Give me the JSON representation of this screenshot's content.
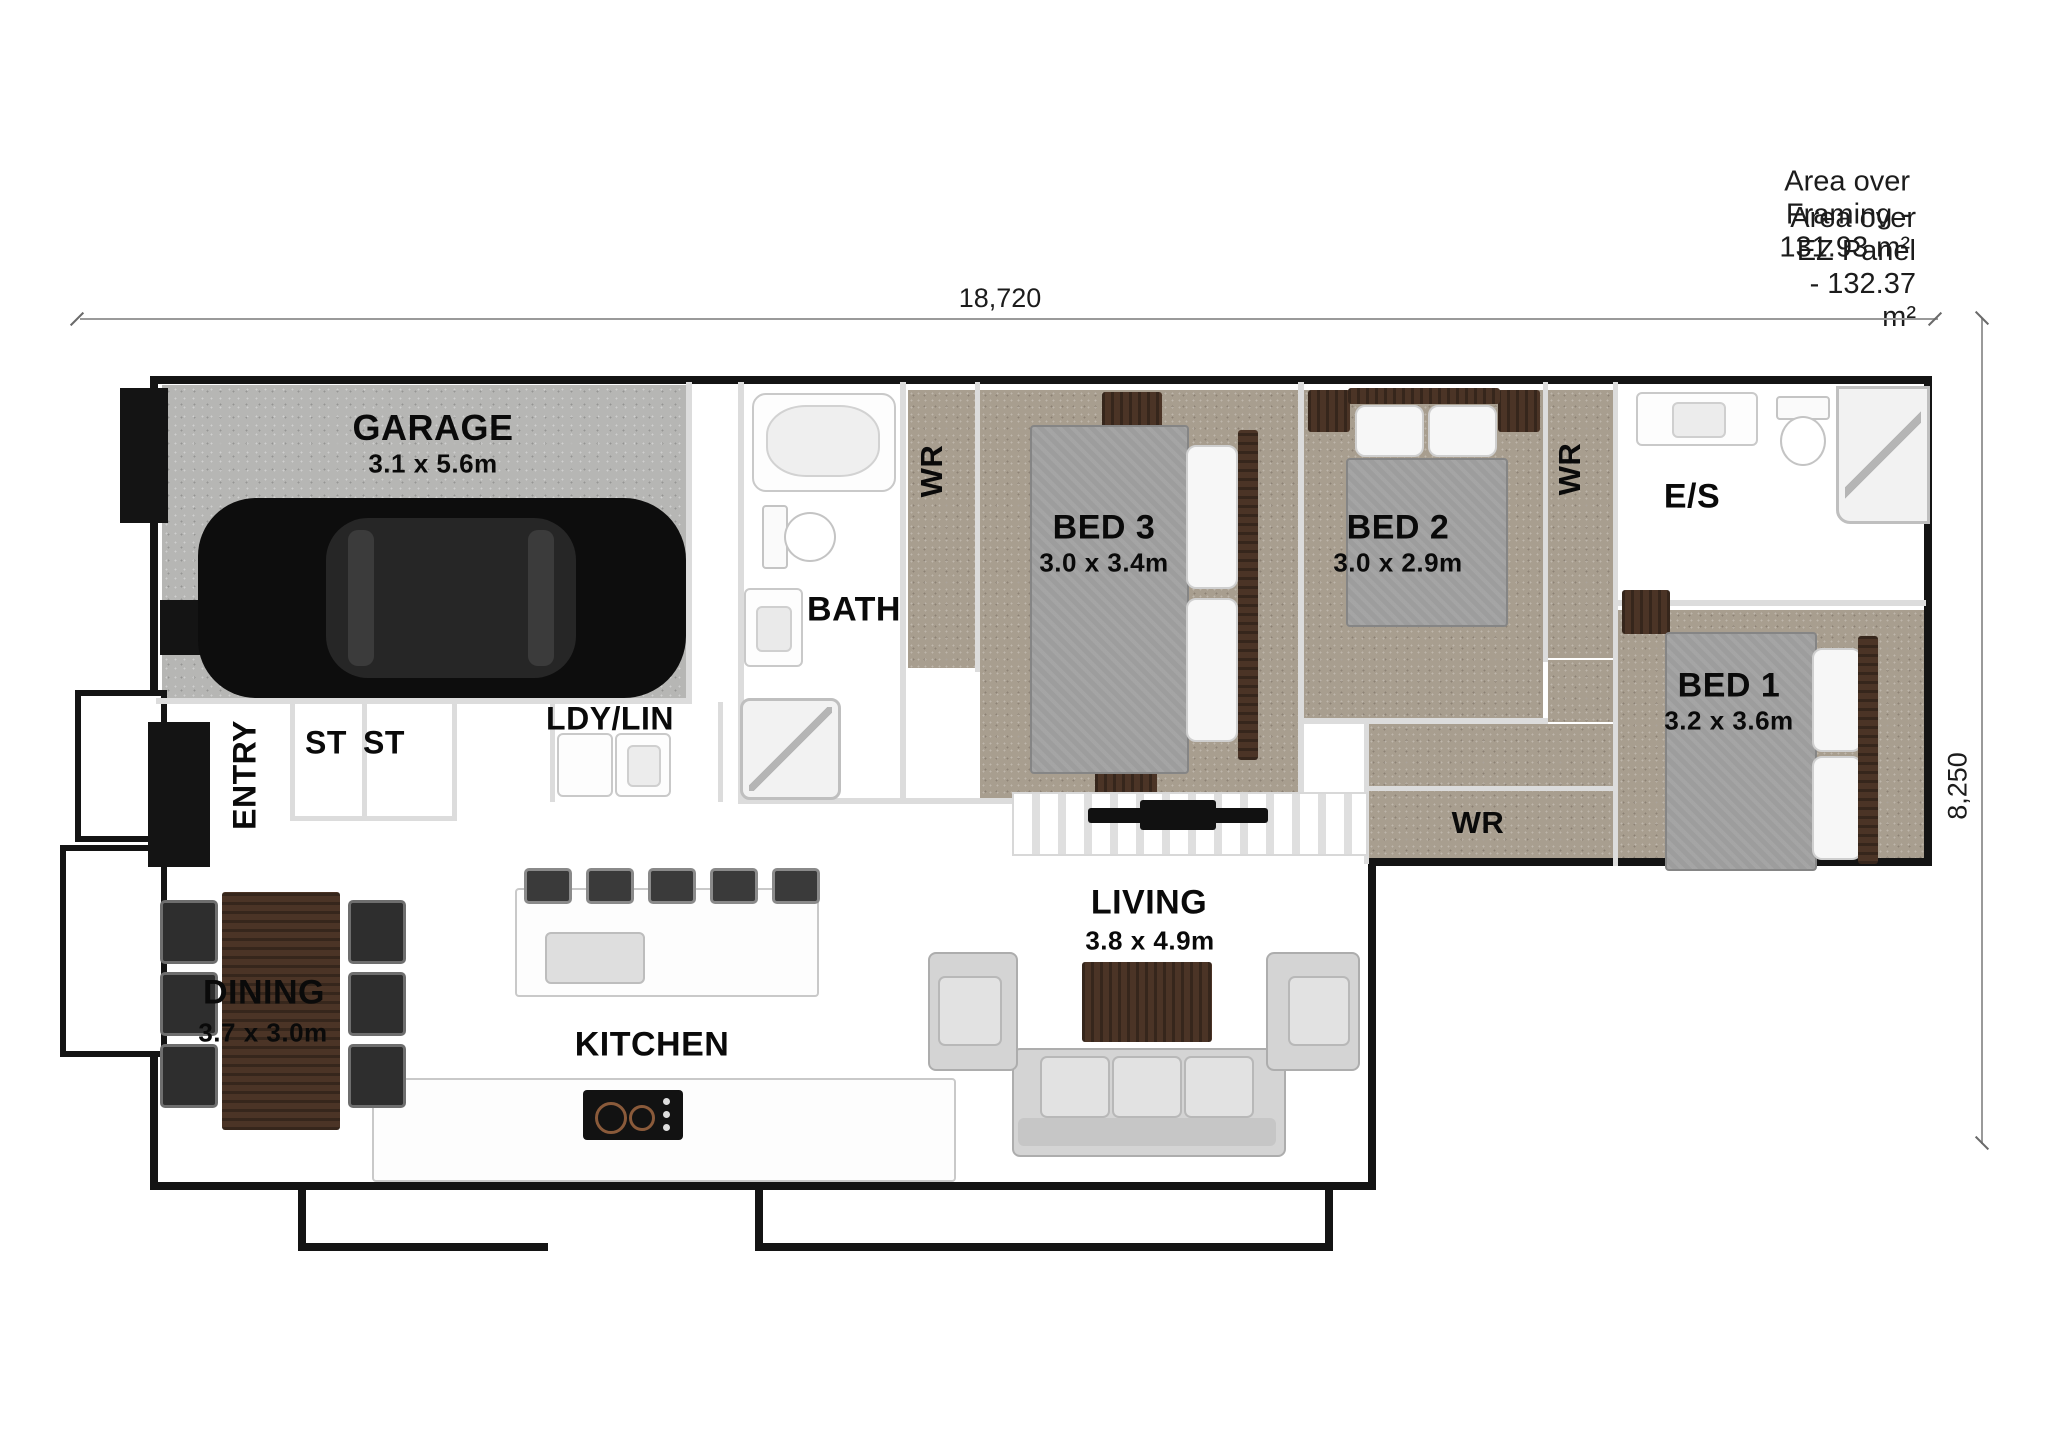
{
  "annotations": {
    "area_framing": "Area over Framing - 131.93 m²",
    "area_ez_panel": "Area over EZ Panel - 132.37 m²"
  },
  "dimensions": {
    "width_label": "18,720",
    "height_label": "8,250"
  },
  "rooms": {
    "garage": {
      "name": "GARAGE",
      "size": "3.1 x 5.6m"
    },
    "entry": {
      "name": "ENTRY"
    },
    "st1": {
      "name": "ST"
    },
    "st2": {
      "name": "ST"
    },
    "ldy_lin": {
      "name": "LDY/LIN"
    },
    "bath": {
      "name": "BATH"
    },
    "wr1": {
      "name": "WR"
    },
    "bed3": {
      "name": "BED 3",
      "size": "3.0 x 3.4m"
    },
    "bed2": {
      "name": "BED 2",
      "size": "3.0 x 2.9m"
    },
    "wr2": {
      "name": "WR"
    },
    "ensuite": {
      "name": "E/S"
    },
    "bed1": {
      "name": "BED 1",
      "size": "3.2 x 3.6m"
    },
    "wr3": {
      "name": "WR"
    },
    "living": {
      "name": "LIVING",
      "size": "3.8 x 4.9m"
    },
    "dining": {
      "name": "DINING",
      "size": "3.7 x 3.0m"
    },
    "kitchen": {
      "name": "KITCHEN"
    }
  },
  "colors": {
    "wall": "#141414",
    "carpet": "#a89e8f",
    "concrete": "#b6b6b4",
    "wood": "#4b3426",
    "fabric": "#d4d4d4"
  }
}
